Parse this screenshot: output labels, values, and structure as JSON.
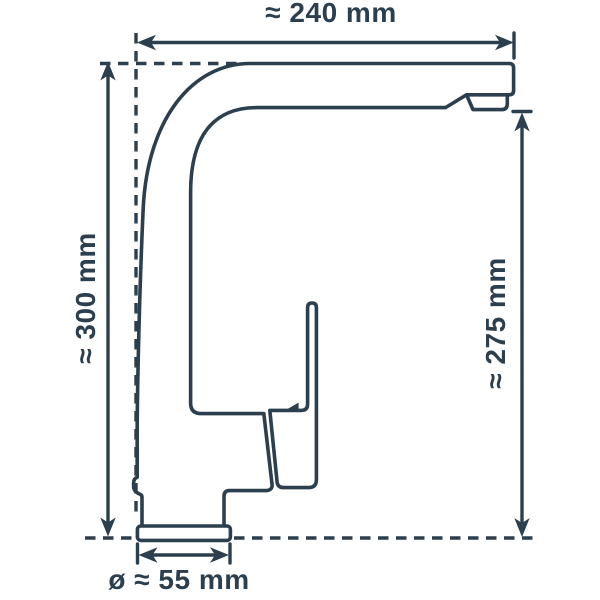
{
  "title": "Kitchen faucet dimension drawing (side view)",
  "colors": {
    "line": "#2c3f4e",
    "background": "#ffffff"
  },
  "drawing": {
    "type": "technical-drawing",
    "subject": "single-lever kitchen mixer tap, side profile with dimension lines",
    "parts": [
      "spout",
      "body-column",
      "lever-handle",
      "cartridge-housing",
      "aerator",
      "base-plate"
    ]
  },
  "dimensions": {
    "top": {
      "label": "≈ 240 mm",
      "value_mm": 240,
      "orientation": "horizontal",
      "measures": "spout reach / overall depth"
    },
    "left": {
      "label": "≈ 300 mm",
      "value_mm": 300,
      "orientation": "vertical",
      "measures": "overall height above counter"
    },
    "right": {
      "label": "≈ 275 mm",
      "value_mm": 275,
      "orientation": "vertical",
      "measures": "spout outlet height above counter"
    },
    "base": {
      "label": "ø ≈ 55 mm",
      "value_mm": 55,
      "orientation": "horizontal",
      "measures": "base plate diameter"
    }
  }
}
